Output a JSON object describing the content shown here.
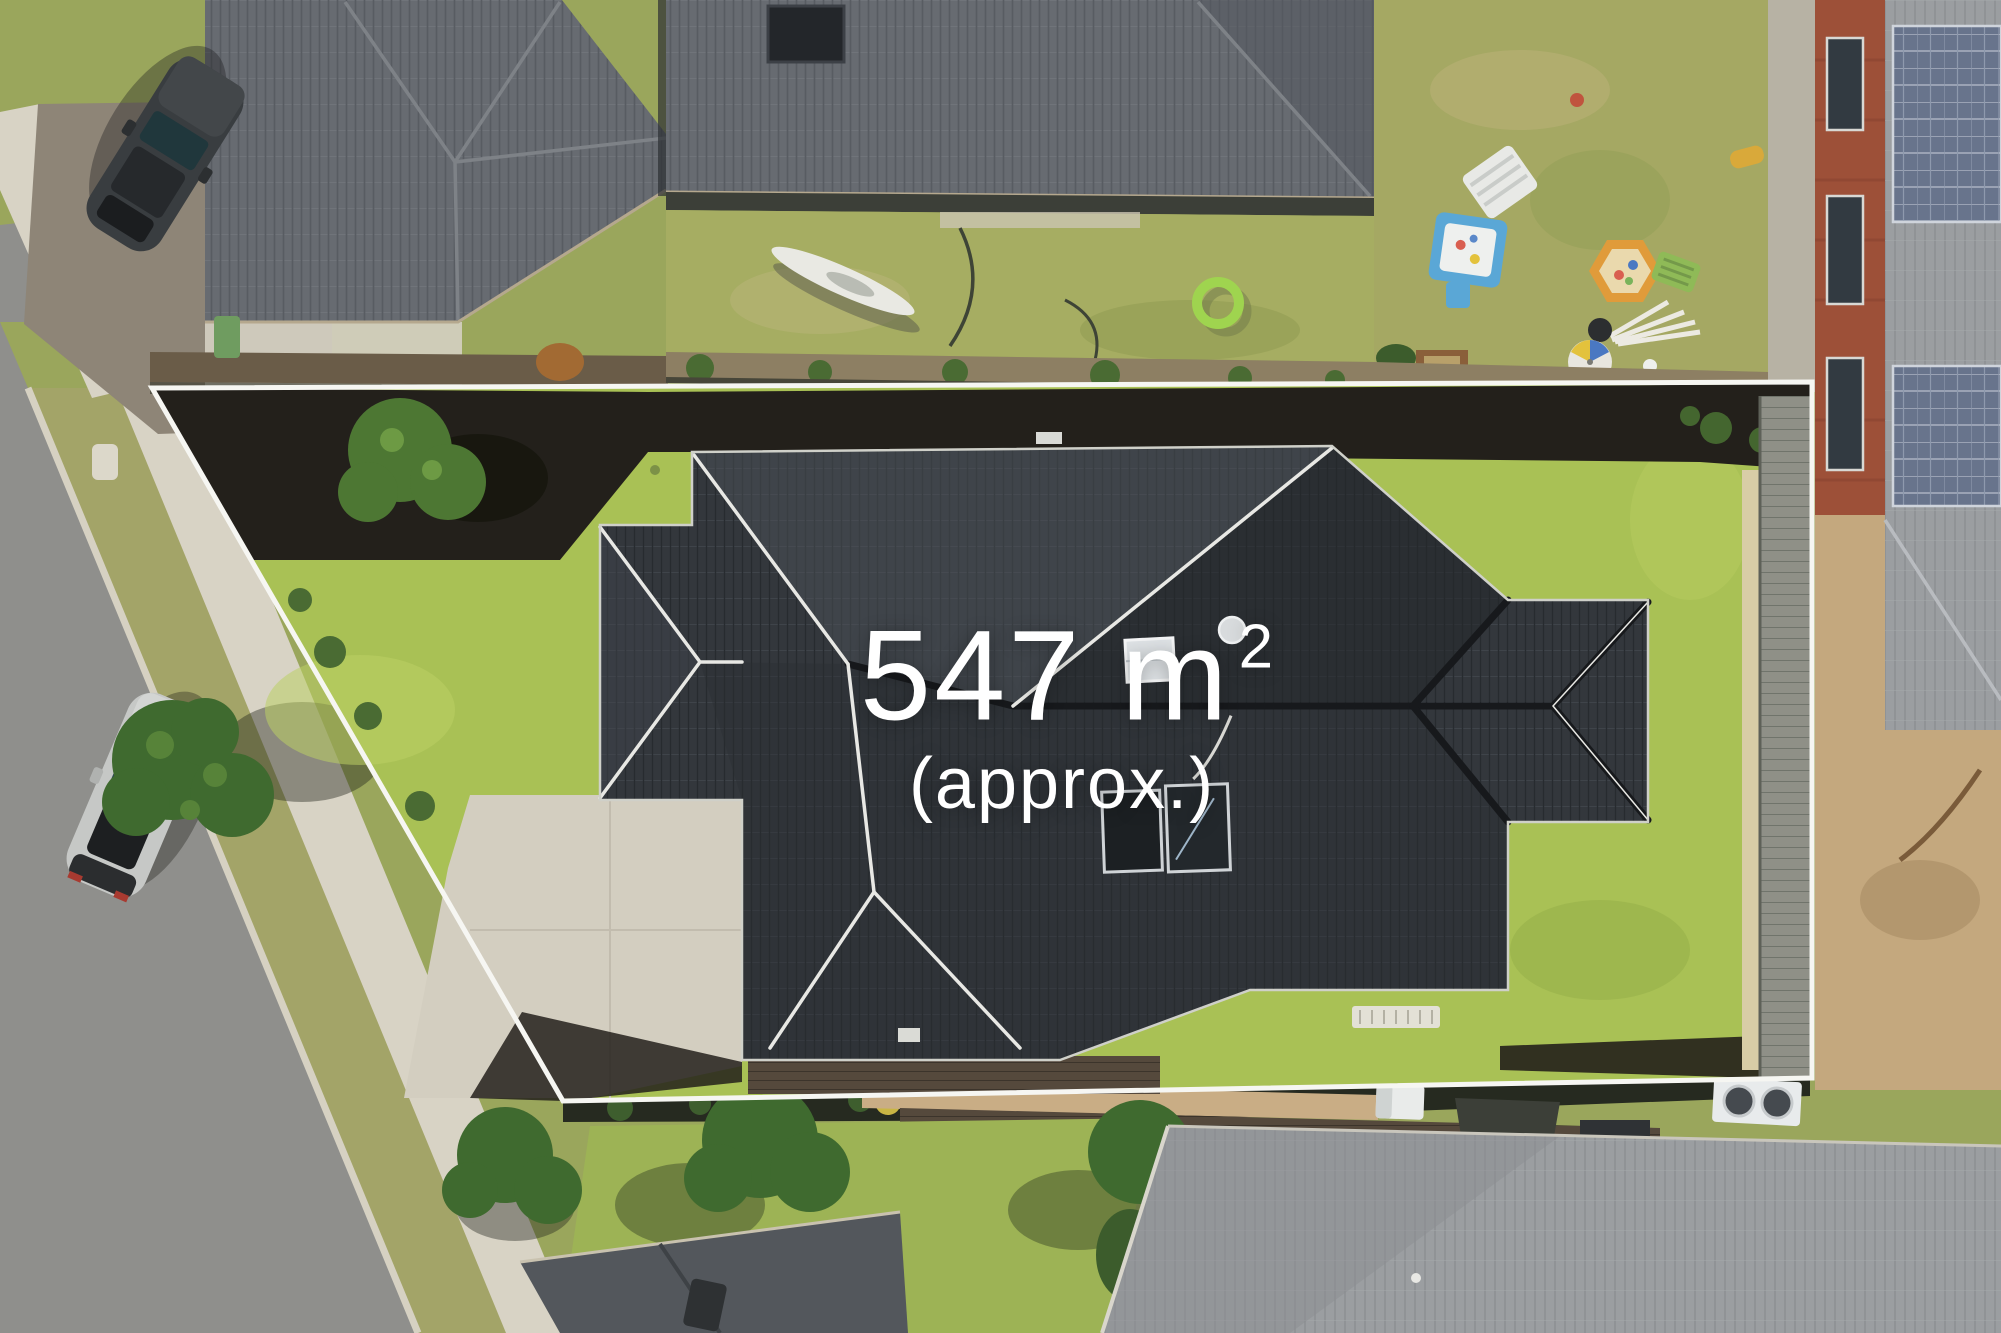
{
  "overlay": {
    "area_value": "547 m",
    "area_superscript": "2",
    "area_qualifier": "(approx.)"
  },
  "colors": {
    "boundary": "#f6f6f2",
    "lot_lawn": "#a9c155",
    "hero_roof_base": "#33373c",
    "mulch": "#23201b",
    "driveway": "#d3cec0",
    "deck_base": "#55493c",
    "fence_base": "#8f9087",
    "road": "#8f8f8c",
    "kerb": "#d6d1c2",
    "footpath": "#d8d3c5",
    "nature_strip": "#a3a468",
    "neighbor_grass": "#9aa65c",
    "neighbor_roof_base": "#676b71",
    "bottom_roof_base": "#9b9ea1",
    "brick_wall": "#9d5038",
    "solar_panel_base": "#68748c",
    "sandy_yard": "#c4a87e",
    "paving": "#c9ad85",
    "tree_canopy": "#3f6a2f",
    "kayak": "#e9e9e3",
    "pool_ring": "#9fd44f",
    "sandpit_blue": "#5aa7d6",
    "sandpit_orange": "#e09b3a",
    "car_dark": "#393d40",
    "car_silver": "#c6c8c6",
    "ac_unit": "#e8ebec",
    "skylight": "#dfe3e6"
  }
}
